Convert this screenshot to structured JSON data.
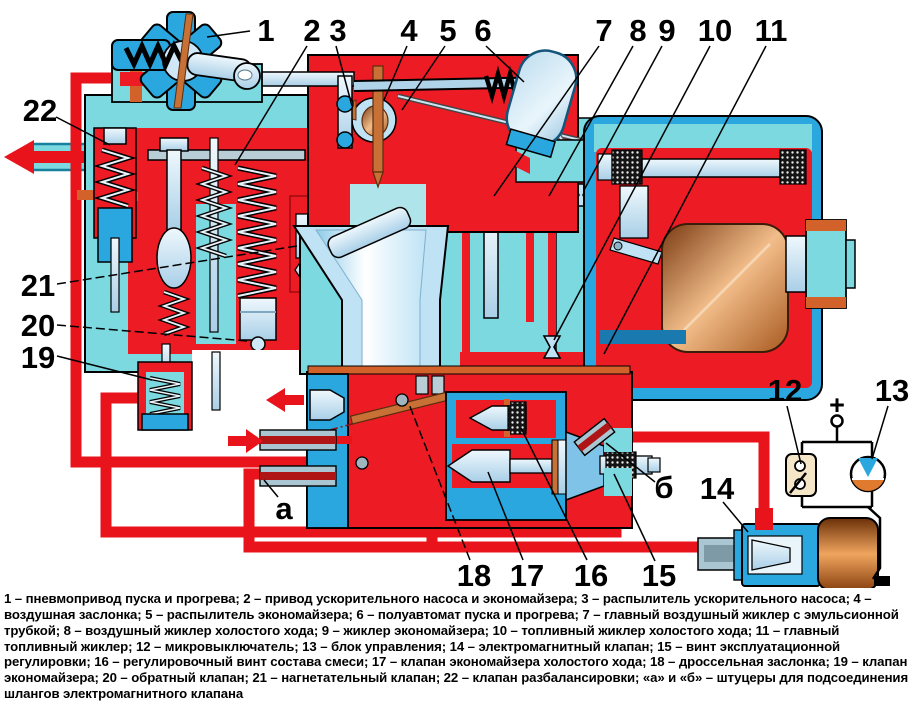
{
  "figure": {
    "kind": "carburetor cross-section schematic",
    "language": "ru",
    "colors": {
      "fuel_red": "#ED1B24",
      "pipe_red": "#E8131B",
      "body_cyan": "#7CD9E0",
      "casing_blue": "#2AA7DF",
      "metal_light": "#D8EBF7",
      "copper": "#C87137",
      "switch_beige": "#F4E6C6",
      "status_orange": "#E07A2E"
    },
    "flow_arrows": [
      {
        "name": "vent-out-arrow",
        "direction": "left"
      },
      {
        "name": "idle-out-arrow",
        "direction": "left"
      },
      {
        "name": "hose-in-arrow",
        "direction": "right"
      }
    ]
  },
  "callouts": [
    {
      "id": "1",
      "label": "1",
      "x": 266,
      "y": 31,
      "line": {
        "x1": 250,
        "y1": 31,
        "x2": 207,
        "y2": 37
      }
    },
    {
      "id": "2",
      "label": "2",
      "x": 312,
      "y": 31,
      "line": {
        "x1": 307,
        "y1": 46,
        "x2": 235,
        "y2": 165
      }
    },
    {
      "id": "3",
      "label": "3",
      "x": 338,
      "y": 31,
      "line": {
        "x1": 336,
        "y1": 46,
        "x2": 352,
        "y2": 106
      }
    },
    {
      "id": "4",
      "label": "4",
      "x": 409,
      "y": 31,
      "line": {
        "x1": 407,
        "y1": 46,
        "x2": 384,
        "y2": 100
      }
    },
    {
      "id": "5",
      "label": "5",
      "x": 448,
      "y": 31,
      "line": {
        "x1": 445,
        "y1": 46,
        "x2": 402,
        "y2": 110
      }
    },
    {
      "id": "6",
      "label": "6",
      "x": 483,
      "y": 31,
      "line": {
        "x1": 486,
        "y1": 46,
        "x2": 524,
        "y2": 82
      }
    },
    {
      "id": "7",
      "label": "7",
      "x": 604,
      "y": 31,
      "line": {
        "x1": 599,
        "y1": 46,
        "x2": 494,
        "y2": 196
      }
    },
    {
      "id": "8",
      "label": "8",
      "x": 638,
      "y": 31,
      "line": {
        "x1": 633,
        "y1": 46,
        "x2": 549,
        "y2": 196
      }
    },
    {
      "id": "9",
      "label": "9",
      "x": 667,
      "y": 31,
      "line": {
        "x1": 662,
        "y1": 46,
        "x2": 584,
        "y2": 190
      }
    },
    {
      "id": "10",
      "label": "10",
      "x": 715,
      "y": 31,
      "line": {
        "x1": 710,
        "y1": 46,
        "x2": 554,
        "y2": 340
      }
    },
    {
      "id": "11",
      "label": "11",
      "x": 771,
      "y": 31,
      "line": {
        "x1": 766,
        "y1": 46,
        "x2": 604,
        "y2": 354
      }
    },
    {
      "id": "12",
      "label": "12",
      "x": 785,
      "y": 391,
      "line": {
        "x1": 787,
        "y1": 406,
        "x2": 801,
        "y2": 464
      }
    },
    {
      "id": "13",
      "label": "13",
      "x": 892,
      "y": 391,
      "line": {
        "x1": 888,
        "y1": 406,
        "x2": 872,
        "y2": 459
      }
    },
    {
      "id": "14",
      "label": "14",
      "x": 717,
      "y": 489,
      "line": {
        "x1": 723,
        "y1": 502,
        "x2": 748,
        "y2": 532
      }
    },
    {
      "id": "15",
      "label": "15",
      "x": 659,
      "y": 576,
      "line": {
        "x1": 655,
        "y1": 561,
        "x2": 614,
        "y2": 474
      }
    },
    {
      "id": "16",
      "label": "16",
      "x": 591,
      "y": 576,
      "line": {
        "x1": 587,
        "y1": 560,
        "x2": 521,
        "y2": 428
      }
    },
    {
      "id": "17",
      "label": "17",
      "x": 527,
      "y": 576,
      "line": {
        "x1": 523,
        "y1": 560,
        "x2": 488,
        "y2": 472
      }
    },
    {
      "id": "18",
      "label": "18",
      "x": 474,
      "y": 576,
      "dash": true,
      "line": {
        "x1": 470,
        "y1": 560,
        "x2": 409,
        "y2": 404
      }
    },
    {
      "id": "19",
      "label": "19",
      "x": 38,
      "y": 358,
      "line": {
        "x1": 57,
        "y1": 356,
        "x2": 152,
        "y2": 380
      }
    },
    {
      "id": "20",
      "label": "20",
      "x": 38,
      "y": 326,
      "dash": true,
      "line": {
        "x1": 57,
        "y1": 325,
        "x2": 247,
        "y2": 341
      }
    },
    {
      "id": "21",
      "label": "21",
      "x": 38,
      "y": 286,
      "dash": true,
      "line": {
        "x1": 57,
        "y1": 284,
        "x2": 297,
        "y2": 246
      }
    },
    {
      "id": "22",
      "label": "22",
      "x": 40,
      "y": 111,
      "line": {
        "x1": 56,
        "y1": 117,
        "x2": 110,
        "y2": 145
      }
    },
    {
      "id": "a",
      "label": "а",
      "x": 284,
      "y": 509,
      "line": {
        "x1": 278,
        "y1": 497,
        "x2": 264,
        "y2": 480
      }
    },
    {
      "id": "b",
      "label": "б",
      "x": 664,
      "y": 488,
      "line": {
        "x1": 655,
        "y1": 482,
        "x2": 606,
        "y2": 443
      }
    },
    {
      "id": "plus",
      "label": "+",
      "x": 837,
      "y": 404,
      "small": true,
      "line": null
    }
  ],
  "legend": {
    "items": [
      {
        "num": "1",
        "text": "пневмопривод пуска и прогрева"
      },
      {
        "num": "2",
        "text": "привод ускорительного насоса и экономайзера"
      },
      {
        "num": "3",
        "text": "распылитель ускорительного насоса"
      },
      {
        "num": "4",
        "text": "воздушная заслонка"
      },
      {
        "num": "5",
        "text": "распылитель экономайзера"
      },
      {
        "num": "6",
        "text": "полуавтомат пуска и прогрева"
      },
      {
        "num": "7",
        "text": "главный воздушный жиклер с эмульсионной трубкой"
      },
      {
        "num": "8",
        "text": "воздушный жиклер холостого хода"
      },
      {
        "num": "9",
        "text": "жиклер экономайзера"
      },
      {
        "num": "10",
        "text": "топливный жиклер холостого хода"
      },
      {
        "num": "11",
        "text": "главный топливный жиклер"
      },
      {
        "num": "12",
        "text": "микровыключатель"
      },
      {
        "num": "13",
        "text": "блок управления"
      },
      {
        "num": "14",
        "text": "электромагнитный клапан"
      },
      {
        "num": "15",
        "text": "винт эксплуатационной регулировки"
      },
      {
        "num": "16",
        "text": "регулировочный винт состава смеси"
      },
      {
        "num": "17",
        "text": "клапан экономайзера холостого хода"
      },
      {
        "num": "18",
        "text": "дроссельная заслонка"
      },
      {
        "num": "19",
        "text": "клапан экономайзера"
      },
      {
        "num": "20",
        "text": "обратный клапан"
      },
      {
        "num": "21",
        "text": "нагнетательный клапан"
      },
      {
        "num": "22",
        "text": "клапан разбалансировки"
      }
    ],
    "note": "«а» и «б» – штуцеры для подсоединения шлангов электромагнитного клапана",
    "caption": "1 – пневмопривод пуска и прогрева; 2 – привод ускорительного насоса и экономайзера; 3 – распылитель ускорительного насоса; 4 – воздушная заслонка; 5 – распылитель экономайзера; 6 – полуавтомат пуска и прогрева; 7 – главный воздушный жиклер с эмульсионной трубкой; 8 – воздушный жиклер холостого хода; 9 – жиклер экономайзера; 10 – топливный жиклер холостого хода; 11 – главный топливный жиклер; 12 – микровыключатель; 13 – блок управления; 14 – электромагнитный клапан; 15 – винт эксплуатационной регулировки; 16 – регулировочный винт состава смеси; 17 – клапан экономайзера холостого хода; 18 – дроссельная заслонка; 19 – клапан экономайзера; 20 – обратный клапан; 21 – нагнетательный клапан; 22 – клапан разбалансировки; «а» и «б» – штуцеры для подсоединения шлангов электромагнитного клапана"
  }
}
